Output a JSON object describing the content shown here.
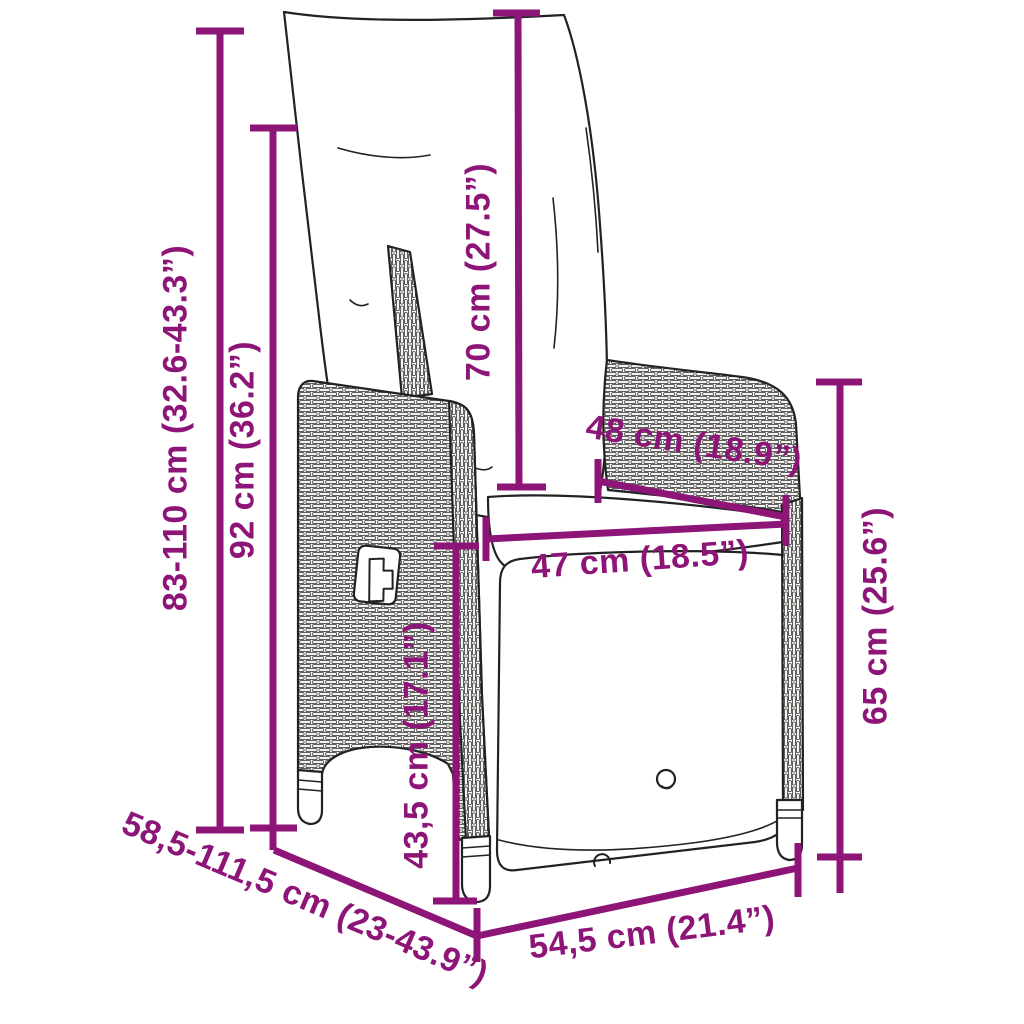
{
  "diagram": {
    "title": "reclining garden chair dimension drawing",
    "colors": {
      "accent": "#8E1578",
      "line_art": "#222222",
      "background": "#ffffff"
    },
    "dimensions": [
      {
        "id": "overall-height",
        "label": "83-110 cm (32.6-43.3”)"
      },
      {
        "id": "backrest-height",
        "label": "92 cm (36.2”)"
      },
      {
        "id": "back-cushion-length",
        "label": "70 cm (27.5”)"
      },
      {
        "id": "seat-width-rear",
        "label": "48 cm (18.9”)"
      },
      {
        "id": "seat-width-front",
        "label": "47 cm (18.5”)"
      },
      {
        "id": "armrest-height",
        "label": "65 cm (25.6”)"
      },
      {
        "id": "seat-height",
        "label": "43,5 cm (17.1”)"
      },
      {
        "id": "overall-depth",
        "label": "58,5-111,5 cm (23-43.9”)"
      },
      {
        "id": "base-width",
        "label": "54,5 cm (21.4”)"
      }
    ]
  }
}
